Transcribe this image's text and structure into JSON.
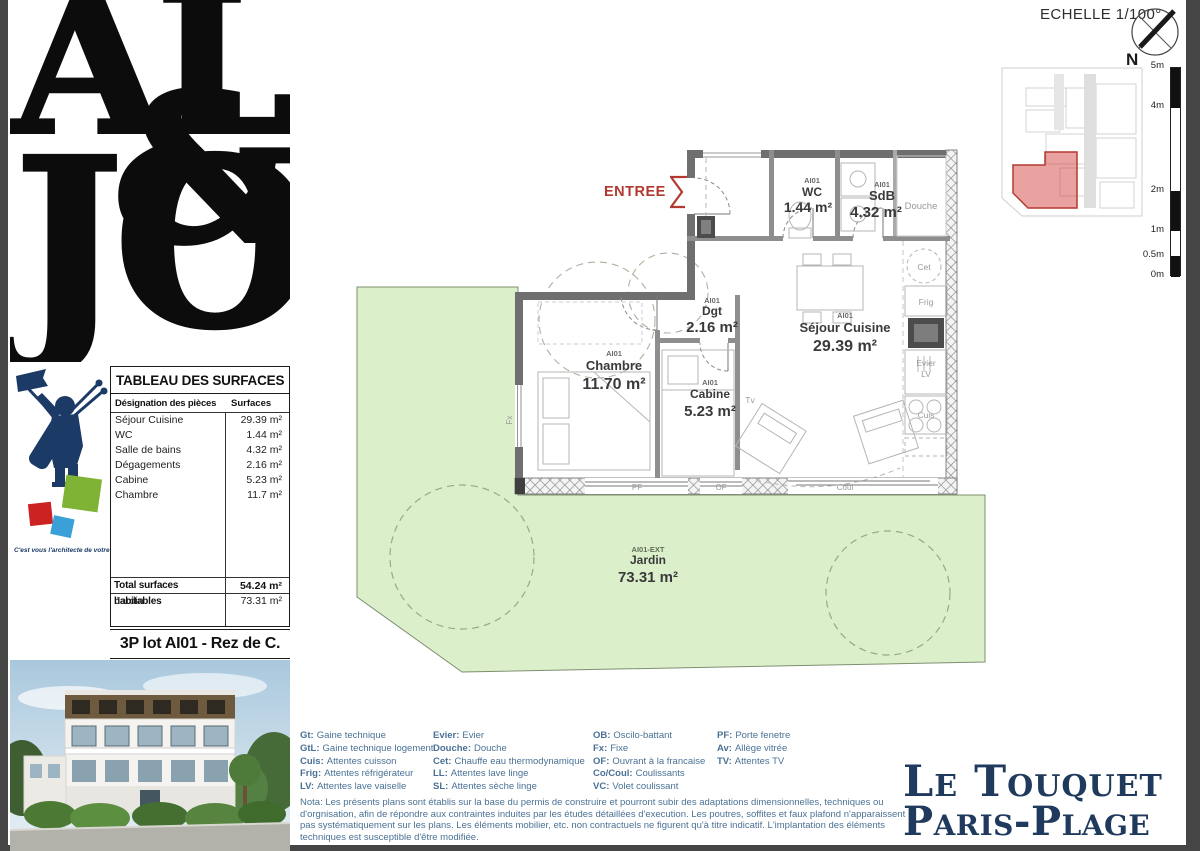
{
  "page": {
    "scale_note": "ECHELLE 1/100°",
    "north_label": "N"
  },
  "sidebar": {
    "logo": {
      "top": "AL",
      "amp": "&",
      "bottom": "JO"
    },
    "tagline": "C'est vous l'architecte de votre vie",
    "surface_table": {
      "title": "TABLEAU DES SURFACES",
      "col_designation": "Désignation des pièces",
      "col_surface": "Surfaces",
      "rows": [
        {
          "label": "Séjour Cuisine",
          "value": "29.39 m²"
        },
        {
          "label": "WC",
          "value": "1.44 m²"
        },
        {
          "label": "Salle de bains",
          "value": "4.32 m²"
        },
        {
          "label": "Dégagements",
          "value": "2.16 m²"
        },
        {
          "label": "Cabine",
          "value": "5.23 m²"
        },
        {
          "label": "Chambre",
          "value": "11.7 m²"
        }
      ],
      "total_label": "Total surfaces habitables",
      "total_value": "54.24 m²",
      "jardin_label": "Jardin",
      "jardin_value": "73.31 m²"
    },
    "lot_title": "3P lot AI01 - Rez de C."
  },
  "plan": {
    "entree_label": "ENTREE",
    "rooms": [
      {
        "code": "AI01",
        "name": "WC",
        "area": "1.44 m²"
      },
      {
        "code": "AI01",
        "name": "SdB",
        "area": "4.32 m²"
      },
      {
        "code": "AI01",
        "name": "Dgt",
        "area": "2.16 m²"
      },
      {
        "code": "AI01",
        "name": "Séjour Cuisine",
        "area": "29.39 m²"
      },
      {
        "code": "AI01",
        "name": "Chambre",
        "area": "11.70 m²"
      },
      {
        "code": "AI01",
        "name": "Cabine",
        "area": "5.23 m²"
      },
      {
        "code": "AI01-EXT",
        "name": "Jardin",
        "area": "73.31 m²"
      }
    ],
    "fixtures": {
      "douche": "Douche",
      "cet": "Cet",
      "frig": "Frig",
      "evier": "Evier",
      "lv": "LV",
      "cuis": "Cuis",
      "tv": "Tv",
      "pf": "PF",
      "of": "OF",
      "coul": "Coul",
      "fx": "Fx"
    }
  },
  "scale_bar": {
    "ticks": [
      "5m",
      "4m",
      "2m",
      "1m",
      "0.5m",
      "0m"
    ]
  },
  "legend": {
    "columns": [
      [
        {
          "abbr": "Gt:",
          "text": "Gaine technique"
        },
        {
          "abbr": "GtL:",
          "text": "Gaine technique logement"
        },
        {
          "abbr": "Cuis:",
          "text": "Attentes cuisson"
        },
        {
          "abbr": "Frig:",
          "text": "Attentes réfrigérateur"
        },
        {
          "abbr": "LV:",
          "text": "Attentes lave vaiselle"
        }
      ],
      [
        {
          "abbr": "Evier:",
          "text": "Evier"
        },
        {
          "abbr": "Douche:",
          "text": "Douche"
        },
        {
          "abbr": "Cet:",
          "text": "Chauffe eau thermodynamique"
        },
        {
          "abbr": "LL:",
          "text": "Attentes lave linge"
        },
        {
          "abbr": "SL:",
          "text": "Attentes sèche linge"
        }
      ],
      [
        {
          "abbr": "OB:",
          "text": "Oscilo-battant"
        },
        {
          "abbr": "Fx:",
          "text": "Fixe"
        },
        {
          "abbr": "OF:",
          "text": "Ouvrant à la francaise"
        },
        {
          "abbr": "Co/Coul:",
          "text": "Coulissants"
        },
        {
          "abbr": "VC:",
          "text": "Volet coulissant"
        }
      ],
      [
        {
          "abbr": "PF:",
          "text": "Porte fenetre"
        },
        {
          "abbr": "Av:",
          "text": "Allège vitrée"
        },
        {
          "abbr": "TV:",
          "text": "Attentes TV"
        }
      ]
    ]
  },
  "nota": "Nota: Les présents plans sont établis sur la base du permis de construire et pourront subir des adaptations dimensionnelles, techniques ou d'orgnisation, afin de répondre aux contraintes induites par les études détaillées d'execution. Les poutres, soffites et faux plafond n'apparaissent pas systématiquement sur les plans. Les éléments mobilier, etc. non contractuels ne figurent qu'à titre indicatif. L'implantation des éléments techniques est susceptible d'être modifiée.",
  "footer": {
    "brand_line1": "Le Touquet",
    "brand_line2": "Paris-Plage"
  }
}
